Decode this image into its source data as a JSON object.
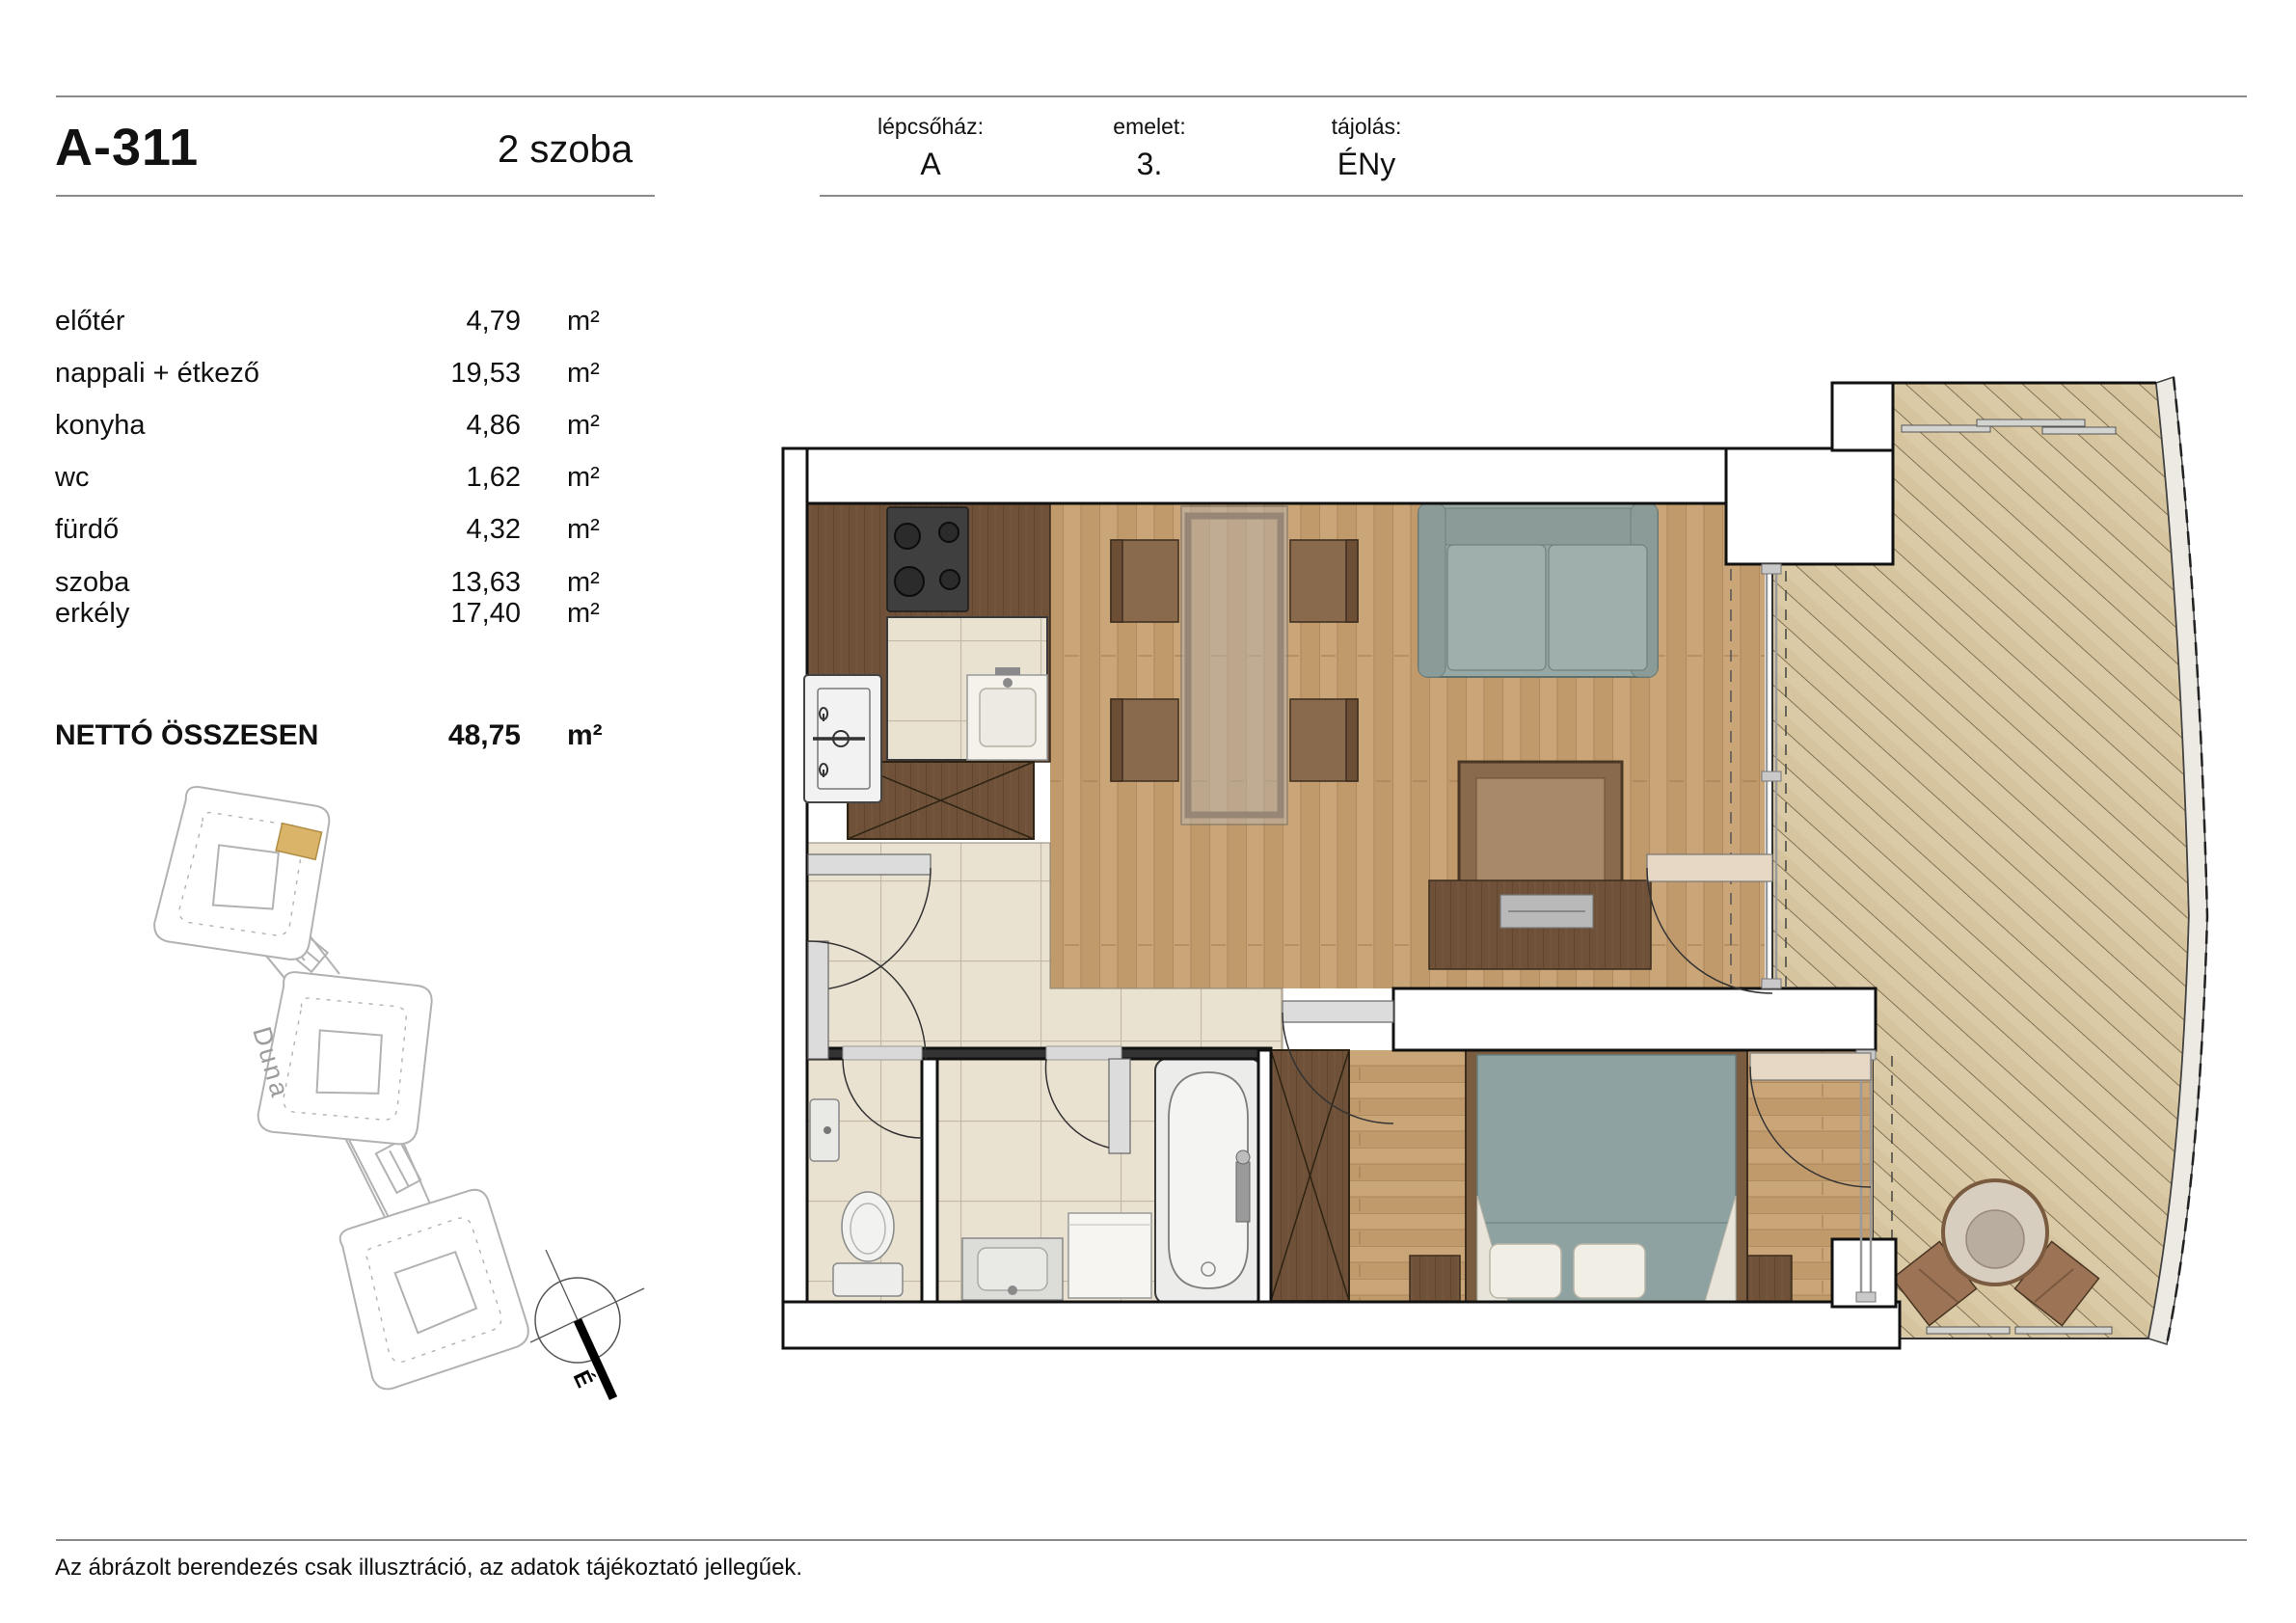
{
  "header": {
    "unit_id": "A-311",
    "room_count": "2 szoba",
    "staircase_label": "lépcsőház:",
    "staircase_value": "A",
    "floor_label": "emelet:",
    "floor_value": "3.",
    "orientation_label": "tájolás:",
    "orientation_value": "ÉNy"
  },
  "areas": {
    "rows": [
      {
        "label": "előtér",
        "value": "4,79",
        "unit": "m²"
      },
      {
        "label": "nappali + étkező",
        "value": "19,53",
        "unit": "m²"
      },
      {
        "label": "konyha",
        "value": "4,86",
        "unit": "m²"
      },
      {
        "label": "wc",
        "value": "1,62",
        "unit": "m²"
      },
      {
        "label": "fürdő",
        "value": "4,32",
        "unit": "m²"
      },
      {
        "label": "szoba",
        "value": "13,63",
        "unit": "m²"
      }
    ],
    "balcony": {
      "label": "erkély",
      "value": "17,40",
      "unit": "m²"
    },
    "total": {
      "label": "NETTÓ ÖSSZESEN",
      "value": "48,75",
      "unit": "m²"
    }
  },
  "site_plan": {
    "river_label": "Duna",
    "north_label": "É"
  },
  "footer": {
    "disclaimer": "Az ábrázolt berendezés csak illusztráció, az adatok tájékoztató jellegűek."
  },
  "colors": {
    "highlight_unit": "#d9b469",
    "wood_floor": "#c6a172",
    "deck_floor": "#dbcaa6",
    "tile_floor": "#eae2d0",
    "cabinet_wood": "#6e5138",
    "upholstery_gray": "#97a8a4"
  }
}
